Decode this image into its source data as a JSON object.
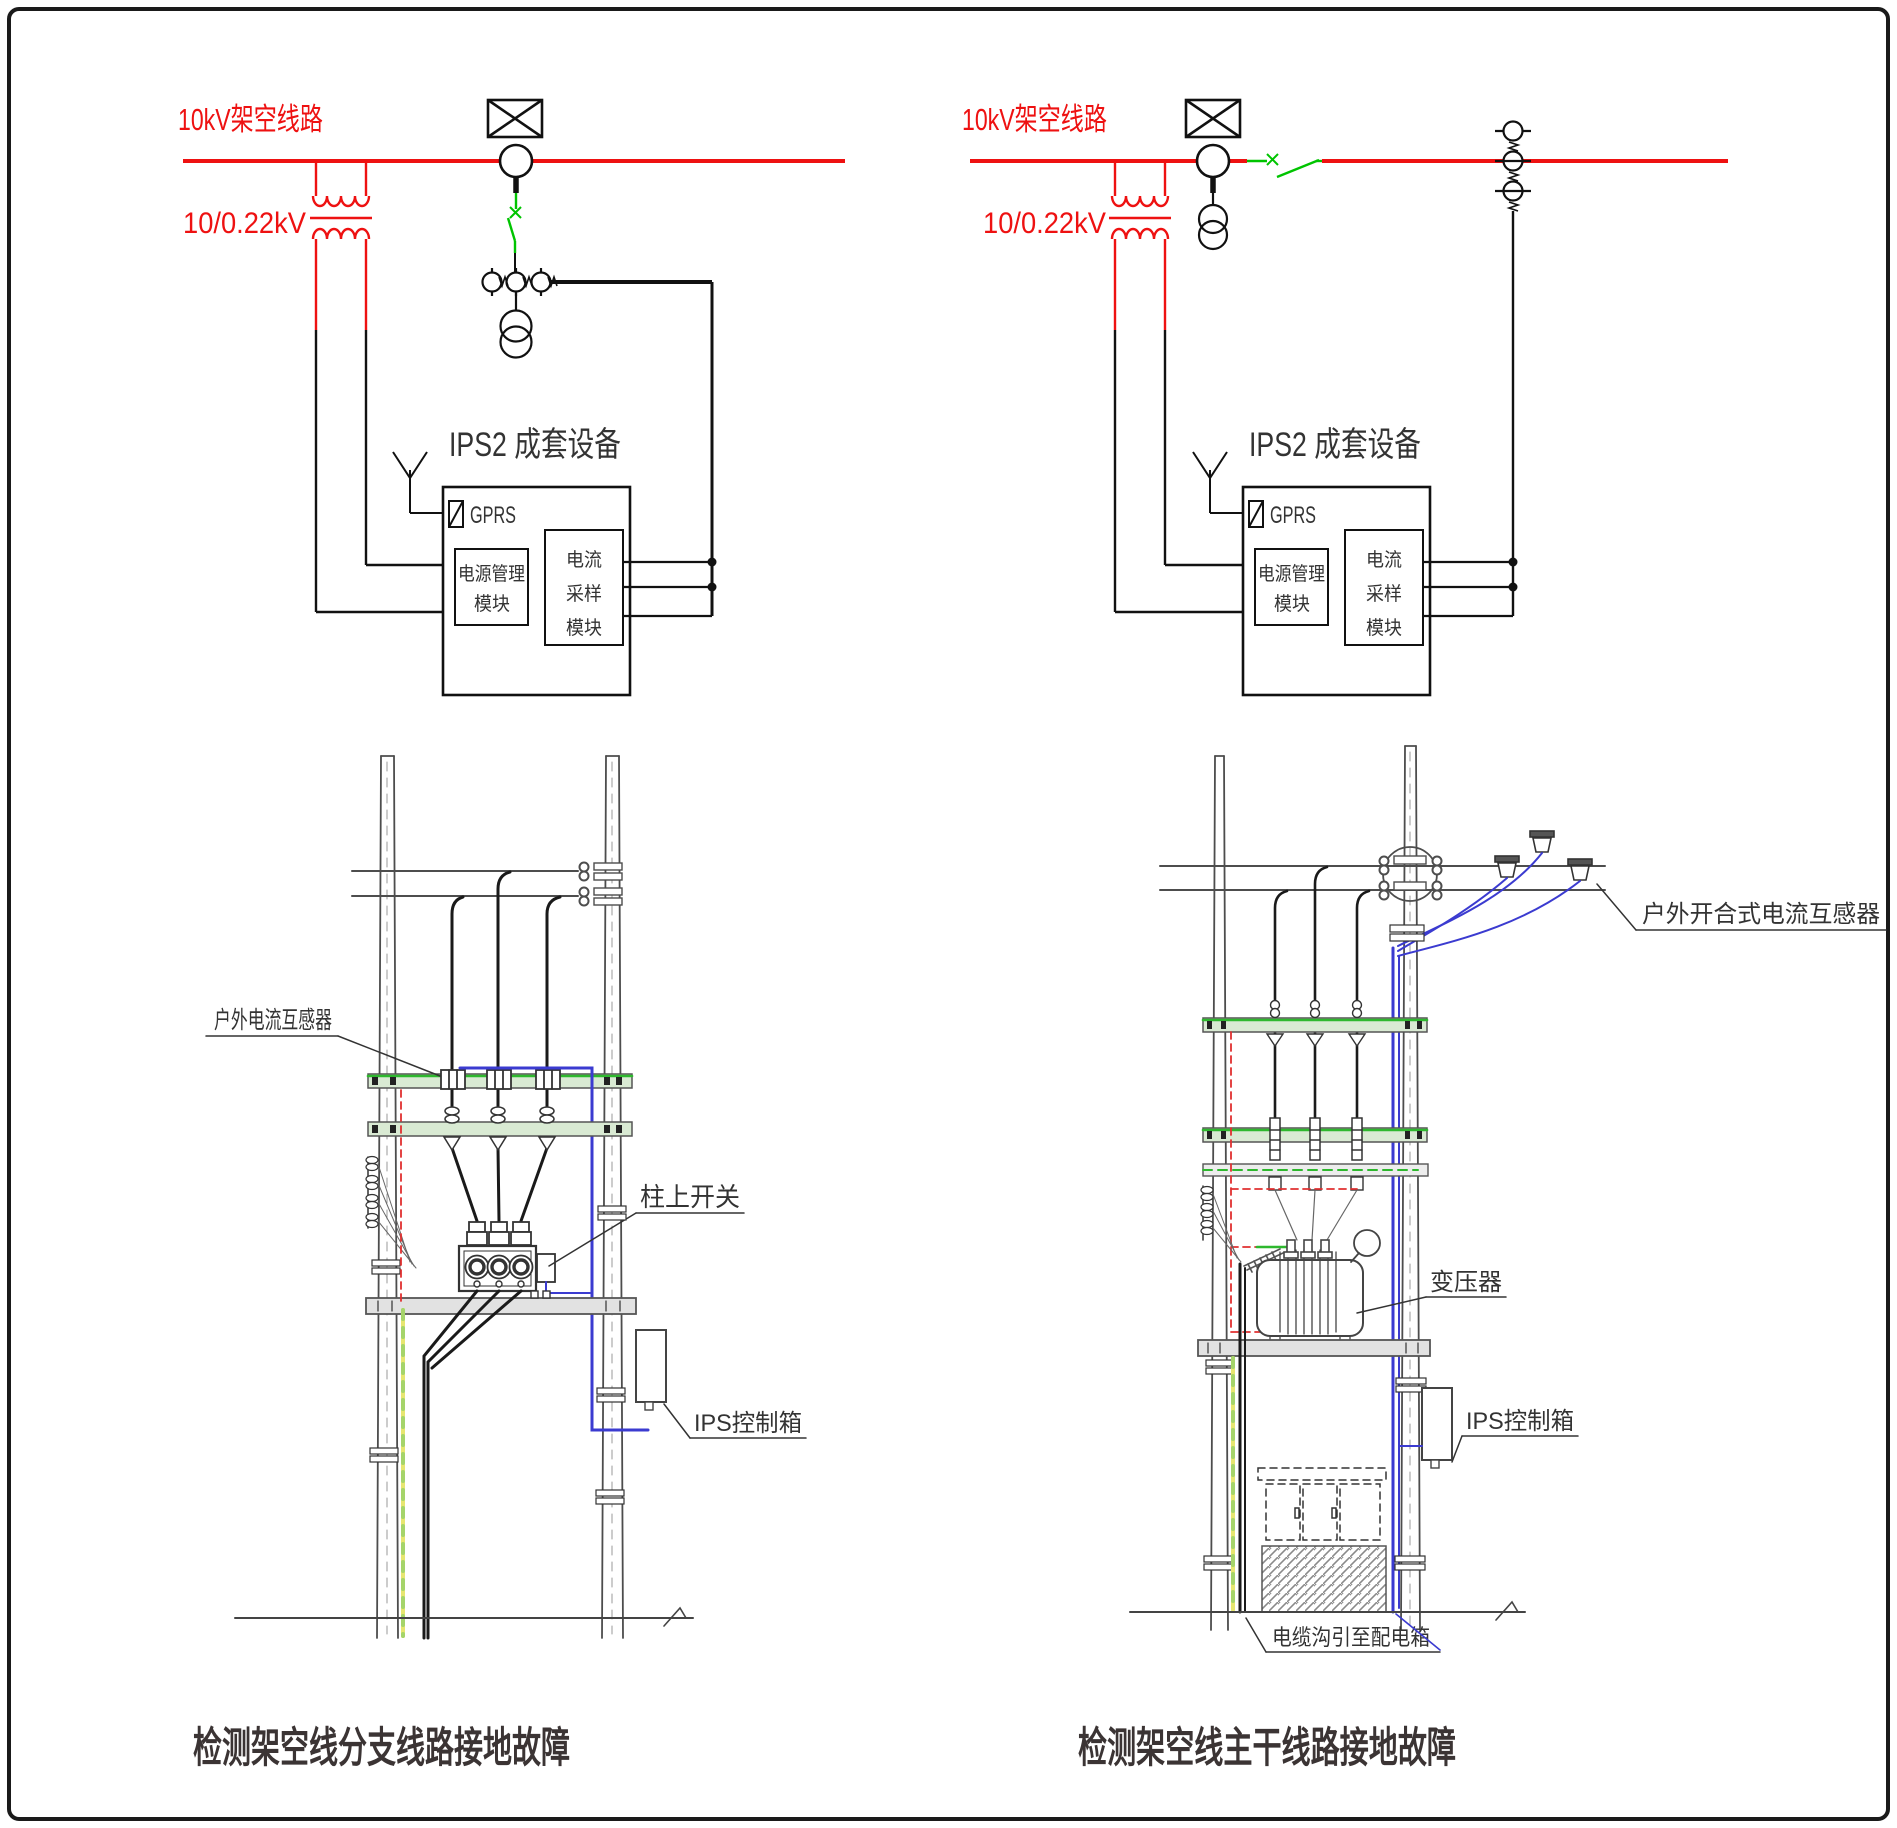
{
  "top_left": {
    "line_label": "10kV架空线路",
    "ratio_label": "10/0.22kV",
    "title": "IPS2 成套设备",
    "gprs": "GPRS",
    "pm1": "电源管理",
    "pm2": "模块",
    "cs1": "电流",
    "cs2": "采样",
    "cs3": "模块"
  },
  "top_right": {
    "line_label": "10kV架空线路",
    "ratio_label": "10/0.22kV",
    "title": "IPS2 成套设备",
    "gprs": "GPRS",
    "pm1": "电源管理",
    "pm2": "模块",
    "cs1": "电流",
    "cs2": "采样",
    "cs3": "模块"
  },
  "bottom_left": {
    "ct_label": "户外电流互感器",
    "switch_label": "柱上开关",
    "box_label": "IPS控制箱",
    "caption": "检测架空线分支线路接地故障"
  },
  "bottom_right": {
    "ct_label": "户外开合式电流互感器",
    "transformer_label": "变压器",
    "box_label": "IPS控制箱",
    "trench_label": "电缆沟引至配电箱",
    "caption": "检测架空线主干线路接地故障"
  },
  "colors": {
    "line_red": "#ee1111",
    "switch_green": "#00c400",
    "crossarm_green": "#2eb82e",
    "wire_blue": "#3b3bd0",
    "ground_yellow": "#e6e670",
    "caption_gray": "#3b3434"
  }
}
